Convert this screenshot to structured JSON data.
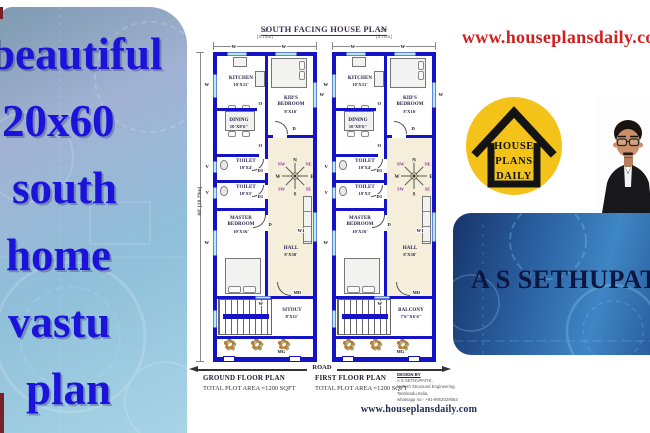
{
  "left_panel": {
    "lines": [
      "beautiful",
      "20x60",
      "south",
      "home",
      "vastu",
      "plan"
    ]
  },
  "top_right": {
    "url": "www.houseplansdaily.com"
  },
  "logo": {
    "line1": "HOUSE",
    "line2": "PLANS",
    "line3": "DAILY"
  },
  "banner": {
    "name": "A S SETHUPATHI"
  },
  "icons": {
    "flower": "✿"
  },
  "plan": {
    "title": "SOUTH FACING HOUSE PLAN",
    "dims": {
      "width_ft": "20'",
      "width_m": "[6.10m]",
      "height_ft": "60'",
      "height_m": "[18.29m]"
    },
    "compass": {
      "n": "N",
      "ne": "NE",
      "e": "E",
      "se": "SE",
      "s": "S",
      "sw": "SW",
      "w": "W",
      "nw": "NW"
    },
    "markers": {
      "window": "W",
      "window1": "W1",
      "vent": "V",
      "door": "D",
      "door1": "D1",
      "opening": "O",
      "main_door": "MD",
      "main_gate": "MG"
    },
    "rooms": {
      "kitchen": {
        "name": "KITCHEN",
        "size": "10'X11'"
      },
      "kids_bedroom": {
        "name": "KID'S",
        "name2": "BEDROOM",
        "size": "8'X16'"
      },
      "dining": {
        "name": "DINING",
        "size": "10'X8'6\""
      },
      "toilet1": {
        "name": "TOILET",
        "size": "10'X4'"
      },
      "toilet2": {
        "name": "TOILET",
        "size": "10'X5'"
      },
      "master": {
        "name": "MASTER",
        "name2": "BEDROOM",
        "size": "10'X16'"
      },
      "hall": {
        "name": "HALL",
        "size": "8'X30'"
      }
    },
    "units": [
      {
        "bottom_room": {
          "name": "SITOUT",
          "size": "8'X11'"
        },
        "caption": {
          "title": "GROUND FLOOR PLAN",
          "area": "TOTAL PLOT AREA =1200 SQFT"
        }
      },
      {
        "bottom_room": {
          "name": "BALCONY",
          "size": "7'6\"X6'6\""
        },
        "caption": {
          "title": "FIRST FLOOR PLAN",
          "area": "TOTAL PLOT AREA =1200 SQFT"
        }
      }
    ],
    "road": "ROAD",
    "credits": {
      "line1": "DESIGN BY",
      "line2": "A S SETHUPATHI,",
      "line3": "M.Tech Structural Engineering,",
      "line4": "Tamilnadu,India,",
      "line5": "whatsapp no:- +91-9952029063"
    },
    "footer_url": "www.houseplansdaily.com"
  }
}
